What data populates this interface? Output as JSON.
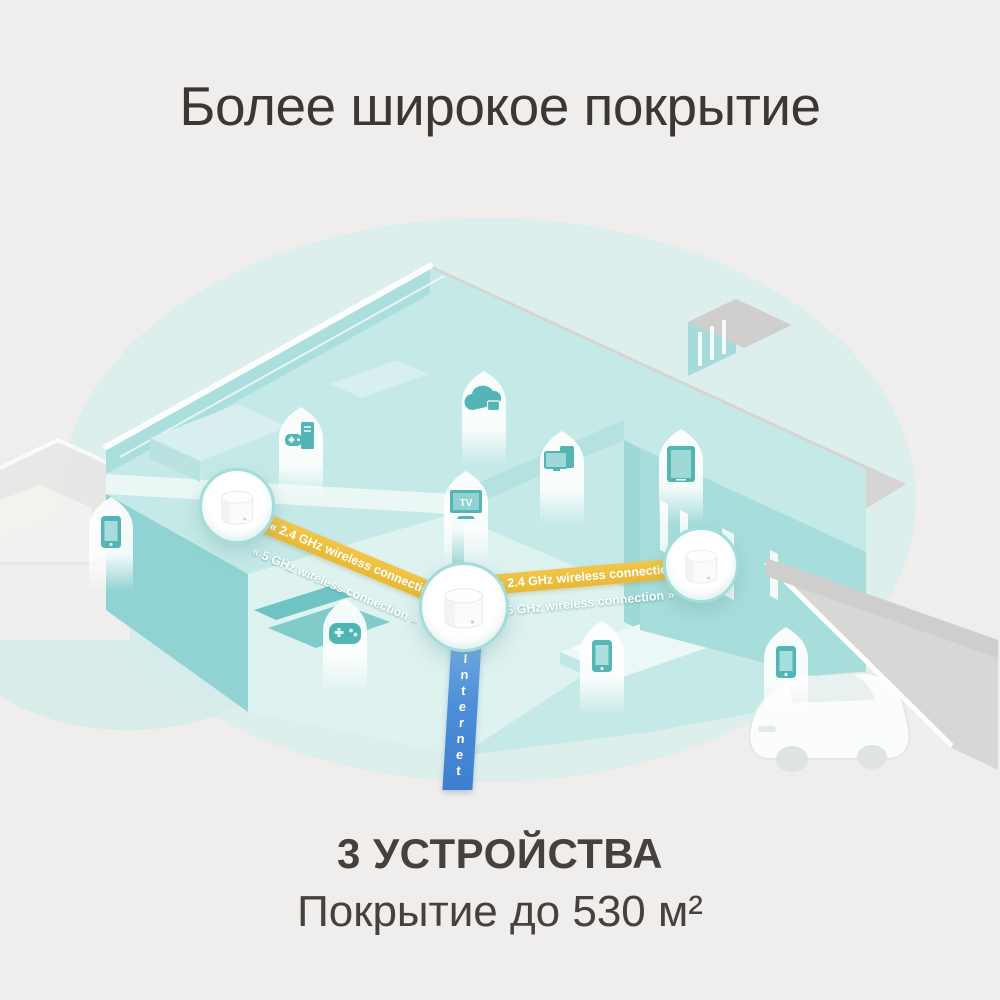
{
  "title": "Более широкое покрытие",
  "links": {
    "left": {
      "band_24ghz": "« 2.4 GHz wireless connection »",
      "band_5ghz": "« 5 GHz wireless connection »"
    },
    "right": {
      "band_24ghz": "« 2.4 GHz wireless connection »",
      "band_5ghz": "« 5 GHz wireless connection »"
    },
    "internet": "Internet"
  },
  "tv_glyph_label": "TV",
  "footer": {
    "devices_count": "3 УСТРОЙСТВА",
    "coverage": "Покрытие до 530 м²"
  },
  "mesh_units": [
    "mesh-router-left",
    "mesh-router-center",
    "mesh-router-right"
  ],
  "device_icons": [
    "smartphone-icon",
    "gaming-pc-icon",
    "cloud-lock-icon",
    "tv-icon",
    "monitor-tablet-icon",
    "tablet-icon",
    "gamepad-icon",
    "smartphone-icon",
    "smartphone-icon"
  ],
  "scene_objects": [
    "isometric-house",
    "dormer",
    "garage",
    "car",
    "neighbor-buildings"
  ],
  "colors": {
    "background": "#f0eeec",
    "blob_teal": "#dcefed",
    "house_teal": "#a7dddb",
    "roof_gray": "#d6d5d3",
    "accent_yellow": "#edbf41",
    "internet_blue": "#4c8ed8",
    "icon_teal": "#4fb3b3",
    "text_dark": "#3a3735"
  }
}
